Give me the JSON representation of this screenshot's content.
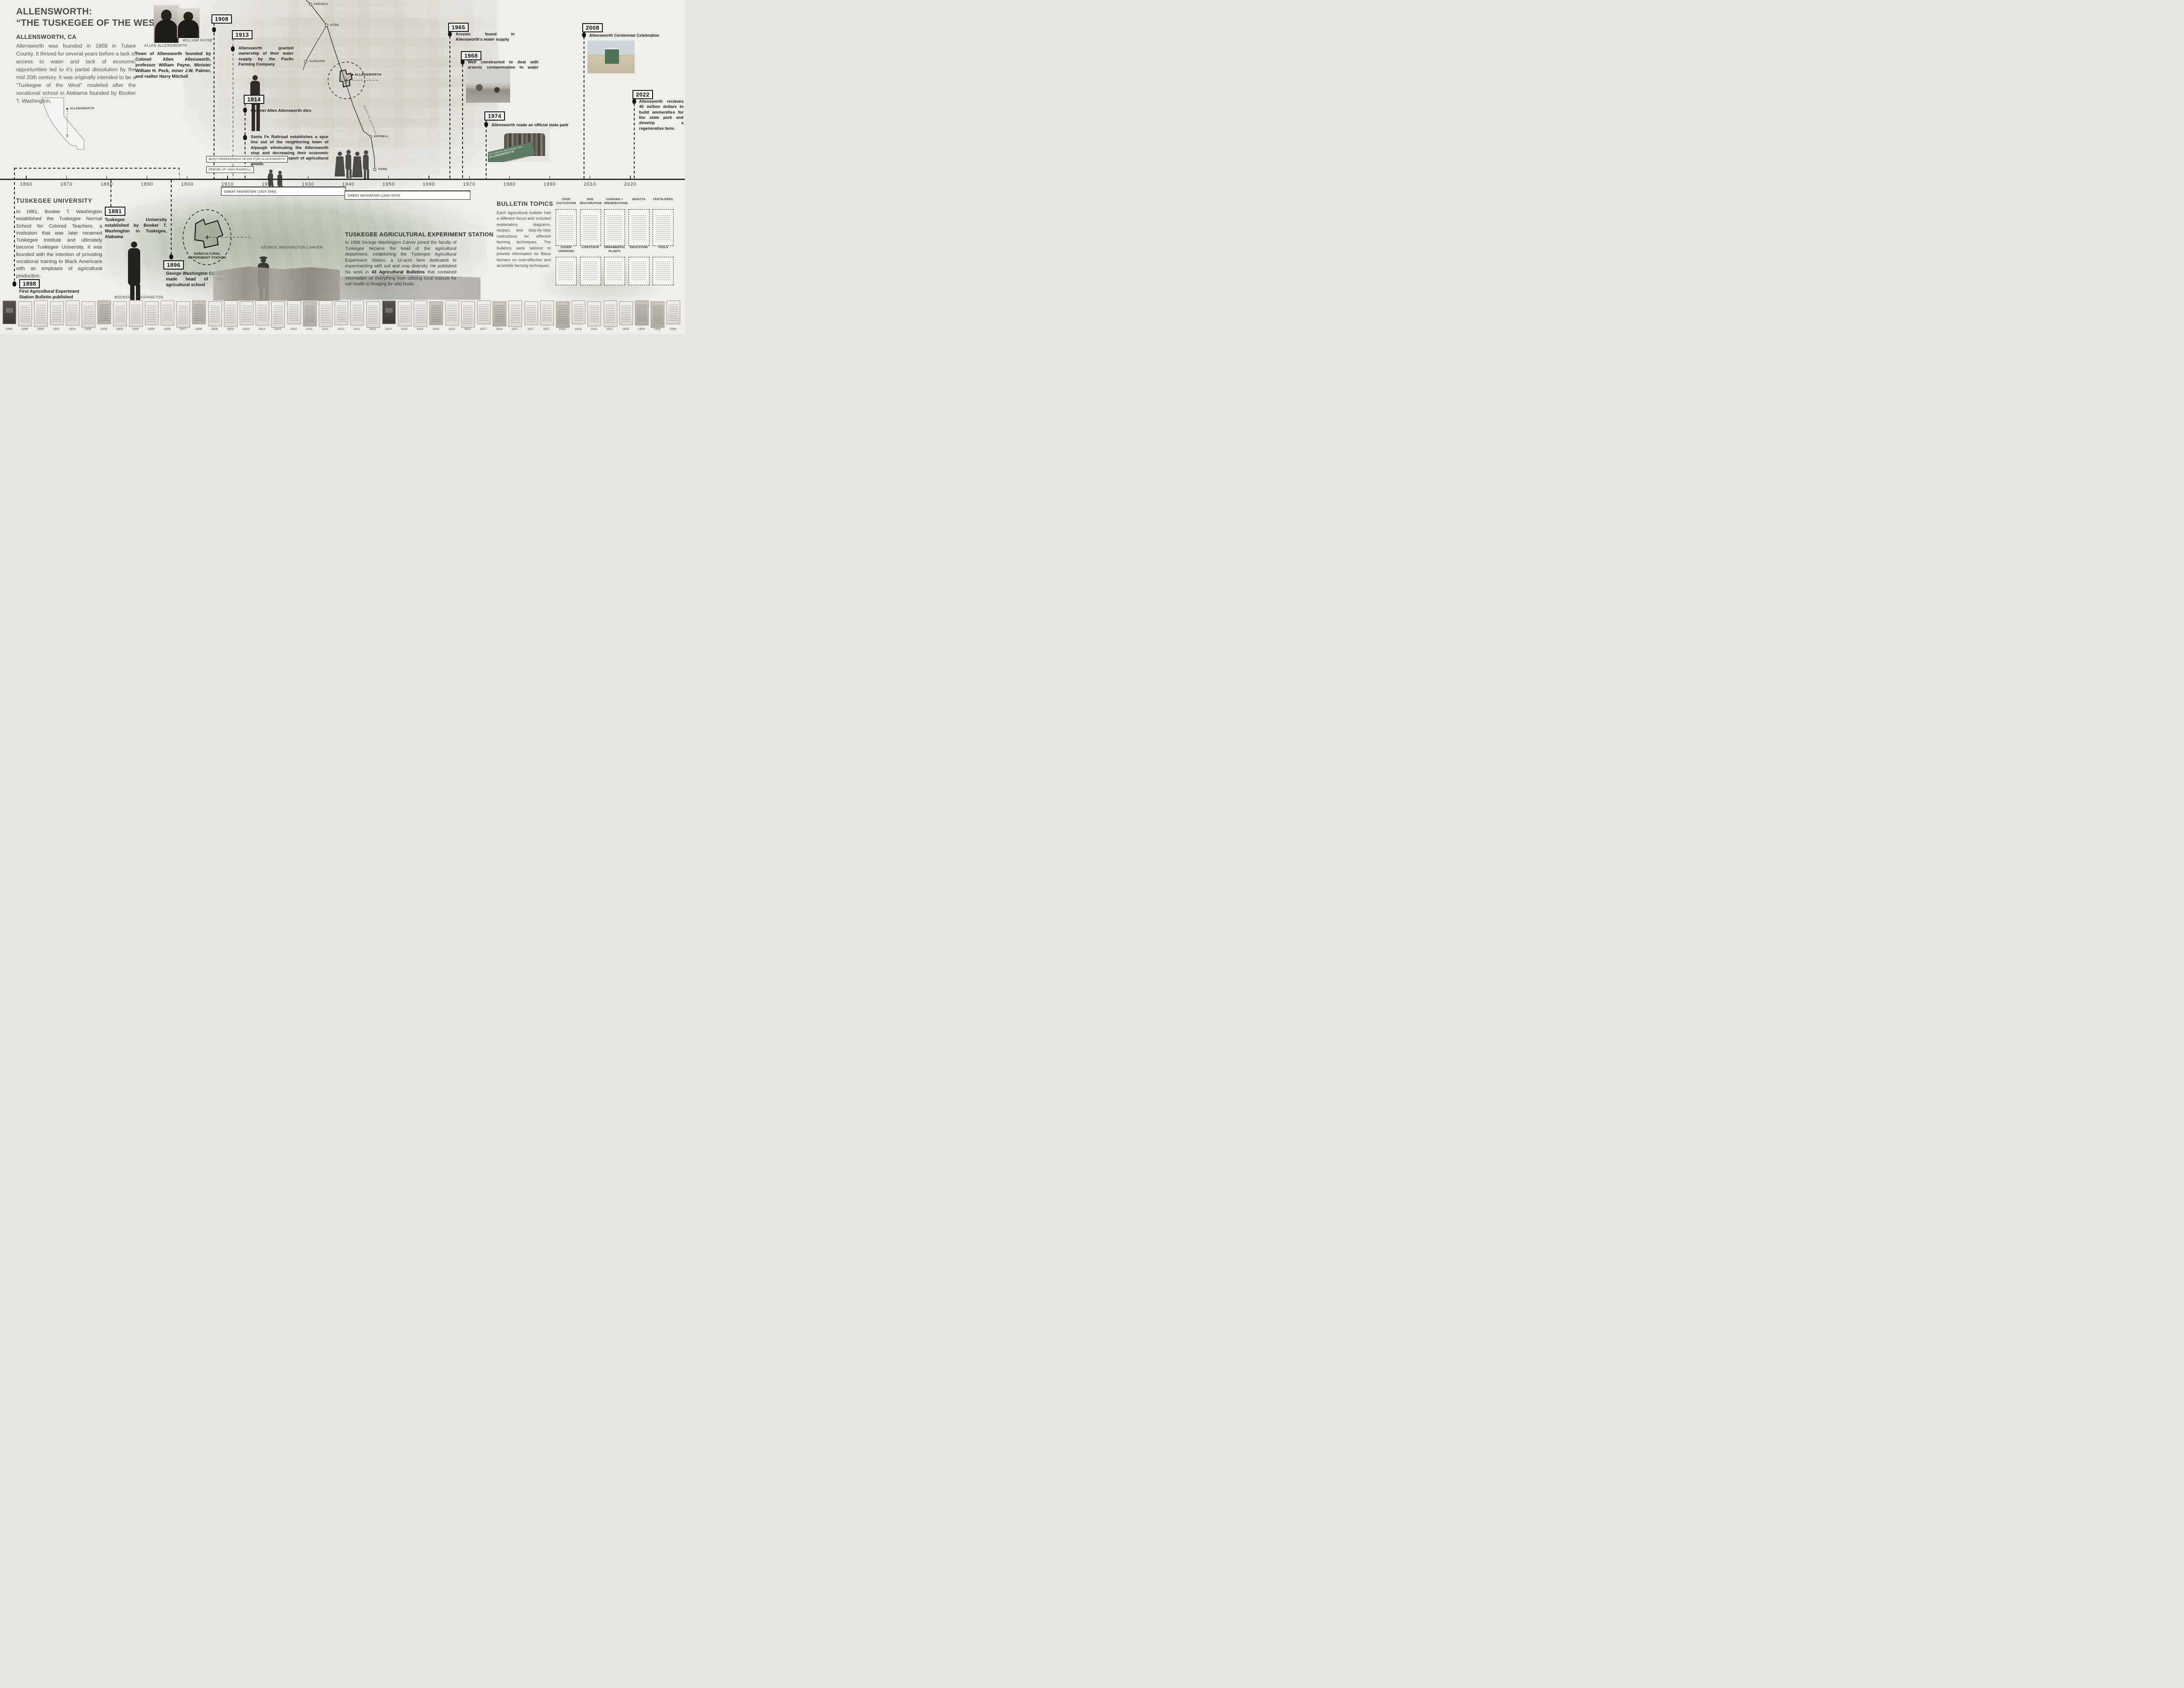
{
  "title": {
    "line1": "ALLENSWORTH:",
    "line2": "“THE TUSKEGEE OF THE WEST”",
    "location": "ALLENSWORTH, CA",
    "intro": "Allensworth was founded in 1908 in Tulare County. It thrived for several years before a lack of access to water and lack of economic opportunities led to it's partial dissolution by the mid 20th century. It was originally intended to be a “Tuskegee of the West” modeled after the vocational school in Alabama founded by Booker T. Washington."
  },
  "founders": {
    "caption_allensworth": "ALLEN ALLENSWORTH",
    "caption_payne": "WILLIAM PAYNE",
    "blurb": "Town of Allensworth founded by Colonel Allen Allensworth, professor William Payne, Minister William H. Peck, miner J.W. Palmer, and realtor Harry Mitchell"
  },
  "events": [
    {
      "year": "1908"
    },
    {
      "year": "1913",
      "text": "Allensworth granted ownership of their water supply by the Pacfic Farming Company"
    },
    {
      "year": "1914",
      "text": "Colonel Allen Allensworth dies"
    },
    {
      "year": "",
      "text": "Santa Fe Railroad establishes a spur line out of the neighboring town of Alpaugh eliminating the Allensworth stop and decreasing their economic opportunities for export of agricultural goods."
    },
    {
      "year": "1965",
      "text": "Arsenic found in Allensworth's water supply"
    },
    {
      "year": "1968",
      "text": "Well constructed to deal with arsenic contamination in water supply"
    },
    {
      "year": "1974",
      "text": "Allensworth made an official state park",
      "banner": "Visit California's Black Historic Town",
      "banner_word": "ALLENSWORTH"
    },
    {
      "year": "2008",
      "text": "Allensworth Centennial Celebration"
    },
    {
      "year": "2022",
      "text": "Allensworth recieves 40 million dollars to build ammenities for the state park and develop a regenerative farm."
    }
  ],
  "period_labels": {
    "prosperous": "MOST PROSPEROUS YEARS FOR ALLENSWORTH",
    "rainfall": "PERIOD OF HIGH RAINFALL"
  },
  "migrations": {
    "first": "GREAT MIGRATION (1910-1940)",
    "second": "GREAT MIGRATION (1940-1970)"
  },
  "axis_years": [
    "1860",
    "1870",
    "1880",
    "1890",
    "1900",
    "1910",
    "1920",
    "1930",
    "1940",
    "1950",
    "1960",
    "1970",
    "1980",
    "1990",
    "2010",
    "2020"
  ],
  "map": {
    "places": [
      "ANGIOLA",
      "STOIL",
      "ALPAUGH",
      "ALLENSWORTH",
      "KERNELL",
      "POND"
    ],
    "railroad": "SANTA FE RAILROAD",
    "state_label": "ALLENSWORTH"
  },
  "tuskegee": {
    "heading": "TUSKEGEE UNIVERSITY",
    "paragraph": "In 1881, Booker T. Washington established the Tuskegee Normal School for Colored Teachers, a institution that was later renamed Tuskegee Institute and ultimately become Tuskegee University. It was founded with the intention of providing vocational training to Black Americans with an emphasis of agricultural production.",
    "event_1881": {
      "year": "1881",
      "text": "Tuskegee University established by Booker T. Washington in Tuskegee, Alabama"
    },
    "event_1896": {
      "year": "1896",
      "text": "George Washington Carver made head of the agricultural school"
    },
    "event_1898": {
      "year": "1898",
      "text": "First Agricultural Experiment Station Bulletin published"
    },
    "caption_btw": "BOOKER T. WASHINGTON",
    "caption_gwc": "GEORGE WASHINGTON CARVER",
    "station_map_label": "AGRICULTURAL EXPERIMENT STATION"
  },
  "station": {
    "heading": "TUSKEGEE AGRICULTURAL EXPERIMENT STATION",
    "p1": "In 1896 George Washington Carver joined the faculty of Tuskegee became the head of the agricultural department, establishing the Tuskegee Agricultural Experiment Station, a 10-acre farm dedicated to experimenting with soil and crop diversity. He published his work in ",
    "bold": "43 Agricultural Bulletins",
    "p2": " that contained information on everything from utilizing local manure for soil health to foraging for wild foods."
  },
  "bulletins": {
    "heading": "BULLETIN TOPICS",
    "paragraph": "Each agricultural bulletin had a different focus and included explanatory diagrams, recipes, and step-by-step instructions for different farming techniques. The bulletins were tailored to provide information for Black farmers on cost-effecitve and accesible farming techniques.",
    "topics": [
      "CROP CULTIVATION",
      "SOIL RESTORATION",
      "COOKING + PRESERVATION",
      "INSECTS",
      "FERTILIZERS",
      "COVER CROPPING",
      "LIVESTOCK",
      "ORNAMENTAL PLANTS",
      "EDUCATION",
      "TOOLS"
    ]
  },
  "strip": {
    "years": [
      "1898",
      "1898",
      "1899",
      "1901",
      "1903",
      "1905",
      "1905",
      "1906",
      "1906",
      "1906",
      "1908",
      "1907",
      "1908",
      "1908",
      "1909",
      "1910",
      "1910",
      "1910",
      "1910",
      "1911",
      "1911",
      "1912",
      "1912",
      "1912",
      "1913",
      "1915",
      "1915",
      "1915",
      "1915",
      "1915",
      "1917",
      "1916",
      "1917",
      "1917",
      "1917",
      "1918",
      "1918",
      "1922",
      "1927",
      "1935",
      "1936",
      "1936",
      "1944"
    ],
    "tones": [
      "d",
      "l",
      "l",
      "l",
      "l",
      "l",
      "m",
      "l",
      "l",
      "l",
      "l",
      "l",
      "m",
      "l",
      "l",
      "l",
      "l",
      "l",
      "l",
      "m",
      "l",
      "l",
      "l",
      "l",
      "d",
      "l",
      "l",
      "m",
      "l",
      "l",
      "l",
      "m",
      "l",
      "l",
      "l",
      "m",
      "l",
      "l",
      "l",
      "l",
      "m",
      "m",
      "l"
    ]
  },
  "colors": {
    "banner_green": "#5d7a63",
    "kiosk_green": "#4e7258",
    "map_marker_red": "#b05548",
    "ink": "#1b1b1b"
  }
}
